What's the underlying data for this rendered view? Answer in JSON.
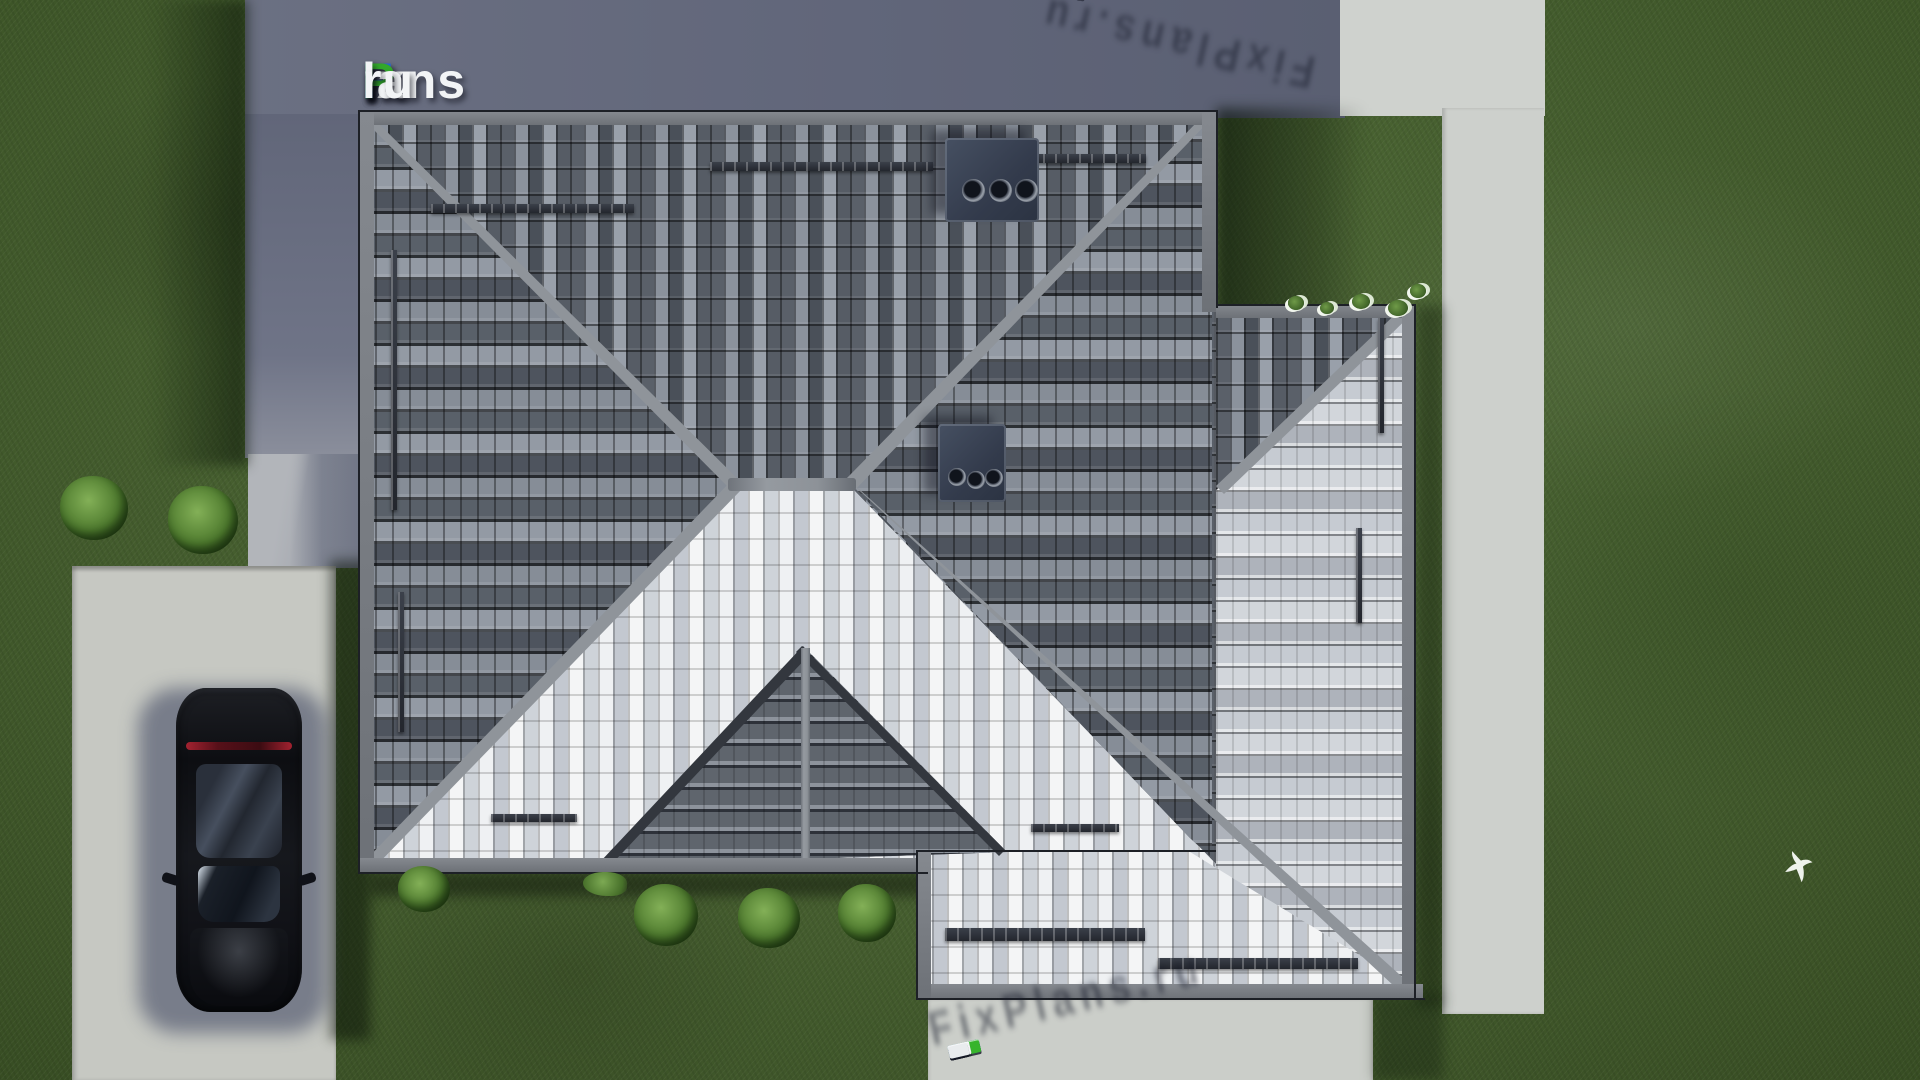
{
  "site": {
    "brand": "FixPlans.ru"
  },
  "watermarks": {
    "logo": {
      "text": "FixPlans.ru",
      "segments": [
        {
          "t": "F",
          "c": "#2a6bd4"
        },
        {
          "t": "ix",
          "c": "#f2f4f6"
        },
        {
          "t": "P",
          "c": "#33a82c"
        },
        {
          "t": "lans",
          "c": "#f2f4f6"
        },
        {
          "t": ".",
          "c": "#2a6bd4"
        },
        {
          "t": "ru",
          "c": "#f2f4f6"
        }
      ]
    },
    "top_right_3d": {
      "text": "FixPlans.ru",
      "rotation_deg": 12.5,
      "reversed": true,
      "blocks": [
        {
          "w": 30,
          "c": "#e9ebee"
        },
        {
          "w": 22,
          "c": "#e9ebee"
        },
        {
          "w": 14,
          "c": "#1f8fe0"
        },
        {
          "w": 34,
          "c": "#f2f3f5"
        },
        {
          "w": 30,
          "c": "#edeff1"
        },
        {
          "w": 24,
          "c": "#e9ebee"
        },
        {
          "w": 34,
          "c": "#37b42c"
        },
        {
          "w": 26,
          "c": "#eff1f3"
        },
        {
          "w": 12,
          "c": "#37b42c"
        },
        {
          "w": 38,
          "c": "#1f8fe0"
        }
      ]
    },
    "bottom_3d": {
      "text": "FixPlans.ru",
      "rotation_deg": -13,
      "reversed": false,
      "blocks": [
        {
          "w": 32,
          "c": "#1f8fe0"
        },
        {
          "w": 12,
          "c": "#eff1f3"
        },
        {
          "w": 20,
          "c": "#e9ecee"
        },
        {
          "w": 32,
          "c": "#37b42c"
        },
        {
          "w": 14,
          "c": "#f0f2f4"
        },
        {
          "w": 20,
          "c": "#eaedef"
        },
        {
          "w": 22,
          "c": "#f2f3f5"
        },
        {
          "w": 12,
          "c": "#1f8fe0"
        },
        {
          "w": 16,
          "c": "#eef0f2"
        },
        {
          "w": 20,
          "c": "#e9ecee"
        }
      ]
    }
  },
  "scene": {
    "type": "aerial-top-view-render-of-hip-roof-house",
    "elements": [
      "hip-roof",
      "right-wing-roof",
      "entrance-gable",
      "chimney-vents",
      "snow-guards",
      "lawn",
      "shadowed-concrete-pad",
      "walkway",
      "driveway",
      "garden-paths",
      "parked-black-car",
      "bushes",
      "flying-white-bird"
    ],
    "palette": {
      "grass": "#4a672f",
      "grass_shadow": "#22351a",
      "concrete_pad_shadow": "#636879",
      "concrete_light": "#cdd0cc",
      "driveway": "#c6c8c2",
      "roof_dark_tiles": "#5f656f",
      "roof_bright_tiles": "#e9ebee",
      "ridge": "#8d9298",
      "chimney": "#39404f",
      "car_body": "#15171c",
      "taillight": "#a32230",
      "brand_blue": "#2a6bd4",
      "brand_green": "#33a82c",
      "wm_blue": "#1f8fe0",
      "wm_green": "#37b42c"
    }
  }
}
